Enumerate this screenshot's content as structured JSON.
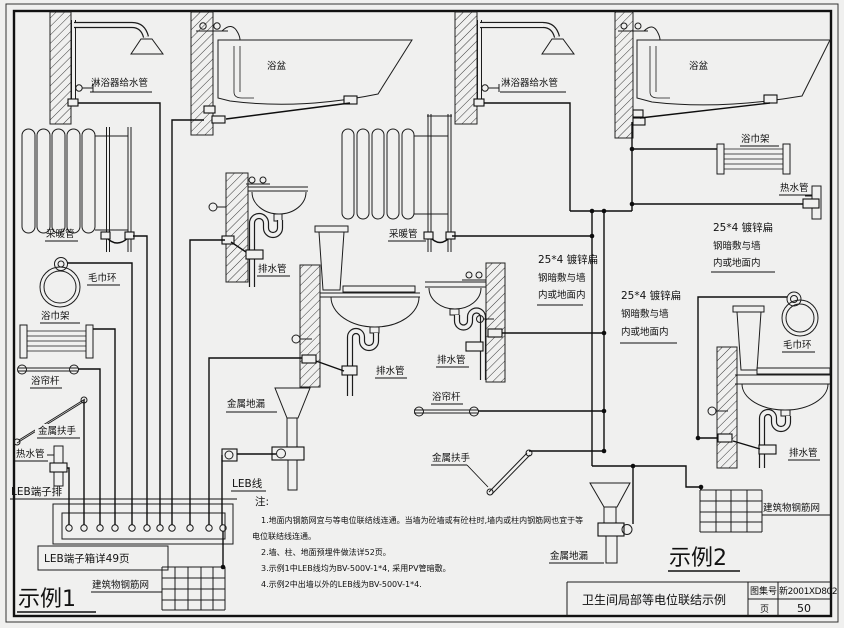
{
  "labels": {
    "shower_supply": "淋浴器给水管",
    "bathtub": "浴盆",
    "heating_pipe": "采暖管",
    "towel_ring": "毛巾环",
    "towel_rack": "浴巾架",
    "curtain_rod": "浴帘杆",
    "handrail": "金属扶手",
    "hot_water_pipe": "热水管",
    "drain_pipe": "排水管",
    "floor_drain": "金属地漏",
    "rebar_mesh": "建筑物钢筋网",
    "leb_terminal_strip": "LEB端子排",
    "leb_wire": "LEB线",
    "leb_box": "LEB端子箱详49页",
    "flat_steel_l1": "25*4 镀锌扁",
    "flat_steel_l2": "钢暗敷与墙",
    "flat_steel_l3": "内或地面内",
    "example1": "示例1",
    "example2": "示例2"
  },
  "notes": {
    "heading": "注:",
    "n1": "1.地面内钢筋网宜与等电位联结线连通。当墙为砼墙或有砼柱时,墙内或柱内钢筋网也宜于等",
    "n1b": "电位联结线连通。",
    "n2": "2.墙、柱、地面预埋件做法详52页。",
    "n3": "3.示例1中LEB线均为BV-500V-1*4, 采用PV管暗敷。",
    "n4": "4.示例2中出墙以外的LEB线为BV-500V-1*4."
  },
  "title_block": {
    "title": "卫生间局部等电位联结示例",
    "atlas_label": "图集号",
    "atlas_value": "新2001XD802",
    "page_label": "页",
    "page_value": "50"
  },
  "colors": {
    "line": "#1c1c1c",
    "background": "#f0f0ef"
  }
}
